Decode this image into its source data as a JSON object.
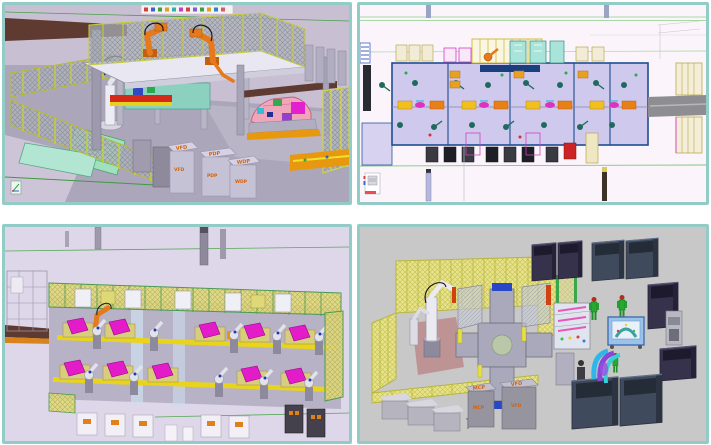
{
  "collage": {
    "frame_color": "#93cbc6",
    "background": "#ffffff",
    "grid": "2x2",
    "panels": {
      "top_left": {
        "name": "robotic-welding-cell-isometric-view",
        "cabinet_labels": [
          "VFD",
          "PDP",
          "WDP"
        ],
        "key_colors": {
          "background": "#c9bfd2",
          "floor": "#aca6bb",
          "robot_orange": "#e6791c",
          "car_body_pink": "#efa6ba",
          "fence_post_yellow": "#c9d22e",
          "brown_beam": "#5e3a31"
        }
      },
      "top_right": {
        "name": "assembly-line-plan-view",
        "key_colors": {
          "background": "#fbf5fb",
          "line_floor": "#cfc9ed",
          "line_border_navy": "#1d4d92",
          "part_magenta": "#e030c0",
          "pallet_yellow": "#f0c020",
          "guide_line_green": "#8cd08c"
        }
      },
      "bottom_left": {
        "name": "assembly-line-isometric-view",
        "key_colors": {
          "background": "#ded7e9",
          "floor": "#b8b2c6",
          "panel_magenta": "#e31bc9",
          "rail_yellow": "#e8d41c",
          "fence_frame_green": "#4a9a52",
          "robot_white": "#e2e2ea"
        }
      },
      "bottom_right": {
        "name": "turntable-cell-with-bins-view",
        "cabinet_labels": [
          "MCP",
          "VFD"
        ],
        "key_colors": {
          "background": "#c8c8c8",
          "fence_yellow": "#eae686",
          "bin_purple": "#37324c",
          "bin_slate": "#3f4a5c",
          "operator_green": "#28a830",
          "rack_blue": "#9cc2e8"
        }
      }
    }
  }
}
